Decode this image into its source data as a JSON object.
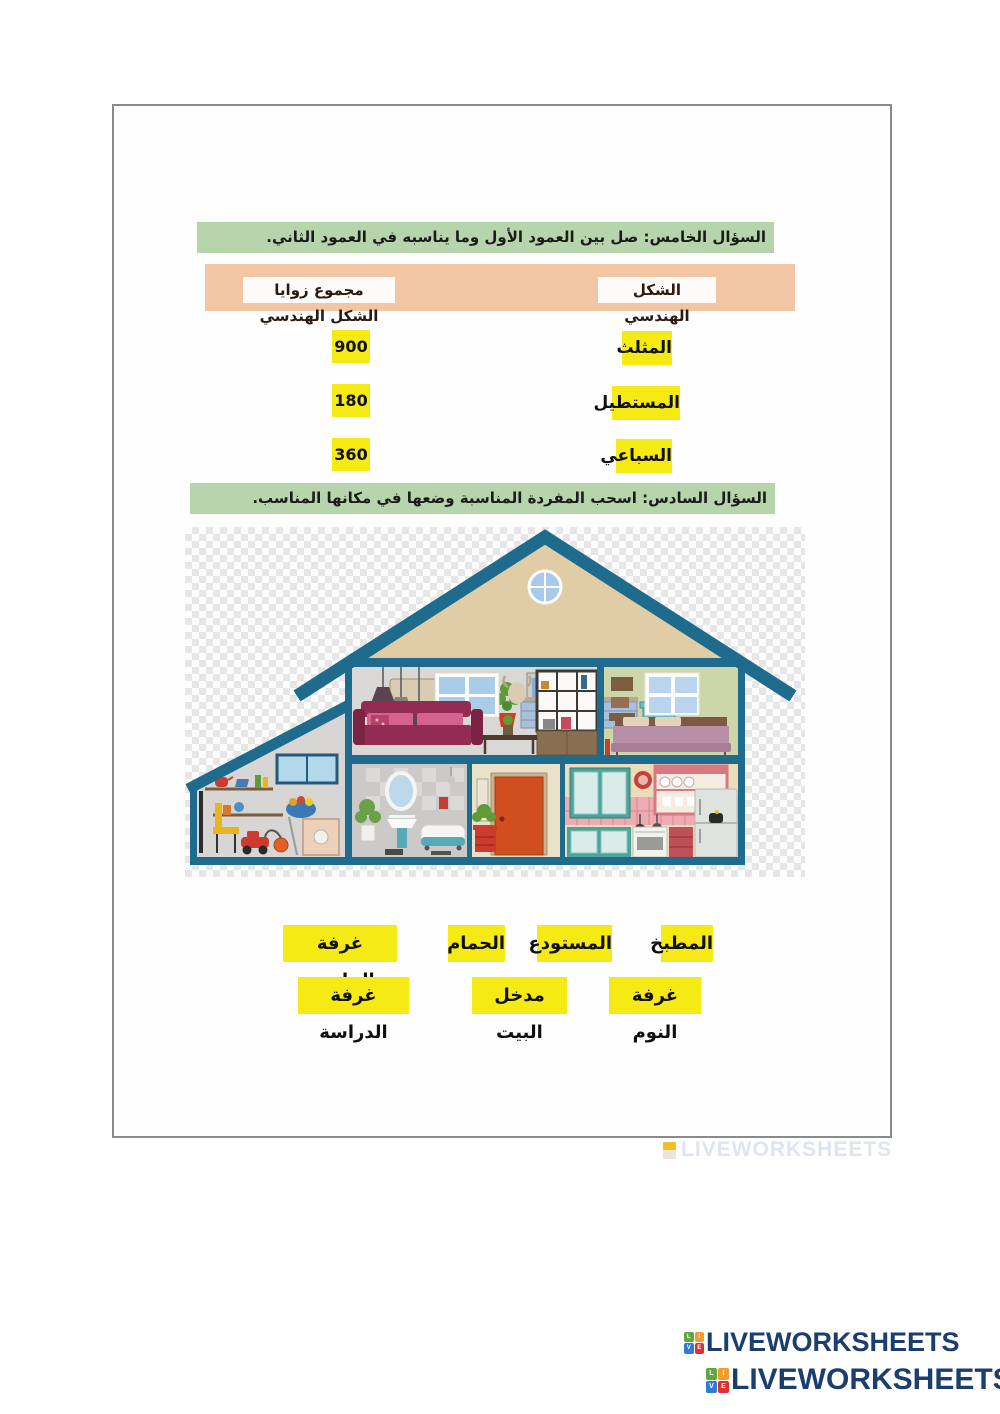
{
  "question5": {
    "header": "السؤال الخامس: صل بين العمود الأول وما يناسبه في العمود الثاني.",
    "columns": {
      "left": "مجموع زوايا الشكل الهندسي",
      "right": "الشكل الهندسي"
    },
    "pairs": [
      {
        "value": "900",
        "shape": "المثلث"
      },
      {
        "value": "180",
        "shape": "المستطيل"
      },
      {
        "value": "360",
        "shape": "السباعي"
      }
    ]
  },
  "question6": {
    "header": "السؤال السادس: اسحب المفردة المناسبة وضعها في مكانها المناسب.",
    "word_bank_row1": [
      "المطبخ",
      "المستودع",
      "الحمام",
      "غرفة الجلوس"
    ],
    "word_bank_row2": [
      "غرفة النوم",
      "مدخل البيت",
      "غرفة الدراسة"
    ]
  },
  "watermark": {
    "text": "LIVEWORKSHEETS"
  },
  "footer": {
    "logos": [
      {
        "text": "LIVEWORKSHEETS"
      },
      {
        "text": "LIVEWORKSHEETS"
      }
    ],
    "icon_letters": [
      "L",
      "I",
      "V",
      "E"
    ]
  },
  "colors": {
    "header_green": "#b7d5ac",
    "table_peach": "#f2c6a4",
    "highlight_yellow": "#f6ea14",
    "logo_navy": "#1c3e6c",
    "icon_green": "#5fa83e",
    "icon_orange": "#f29b2e",
    "icon_blue": "#2e7cd6",
    "icon_red": "#e23030",
    "house_structure_teal": "#1e6b8d"
  }
}
